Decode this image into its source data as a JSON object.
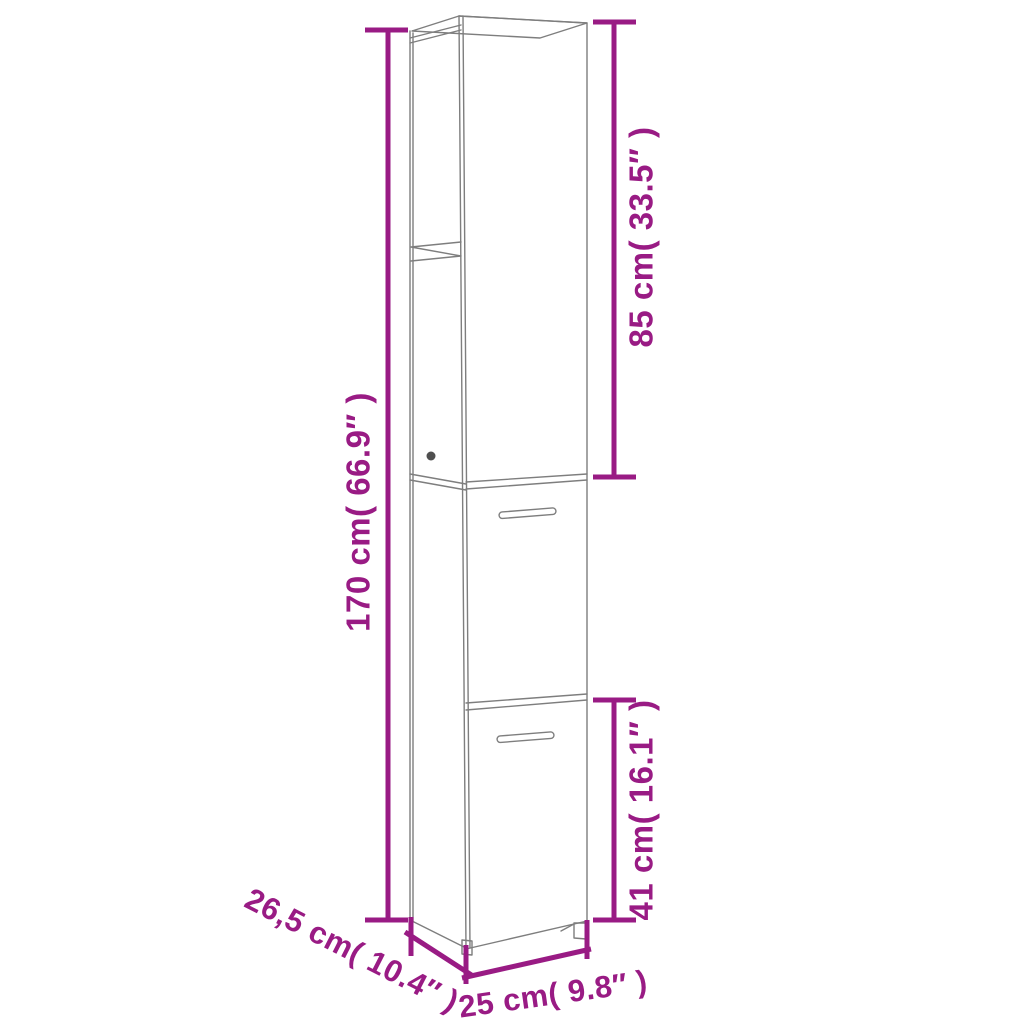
{
  "colors": {
    "dimension": "#991B84",
    "cabinet_line": "#7E7E7E",
    "cabinet_dark": "#4F4F4F",
    "background": "#FFFFFF"
  },
  "diagram": {
    "type": "product-dimension-diagram",
    "subject": "tall-narrow-bathroom-cabinet",
    "labels": {
      "total_height": "170 cm( 66.9″ )",
      "upper_section_height": "85 cm( 33.5″ )",
      "lower_section_height": "41 cm( 16.1″ )",
      "depth": "26,5 cm( 10.4″ )",
      "width": "25 cm( 9.8″ )"
    }
  }
}
